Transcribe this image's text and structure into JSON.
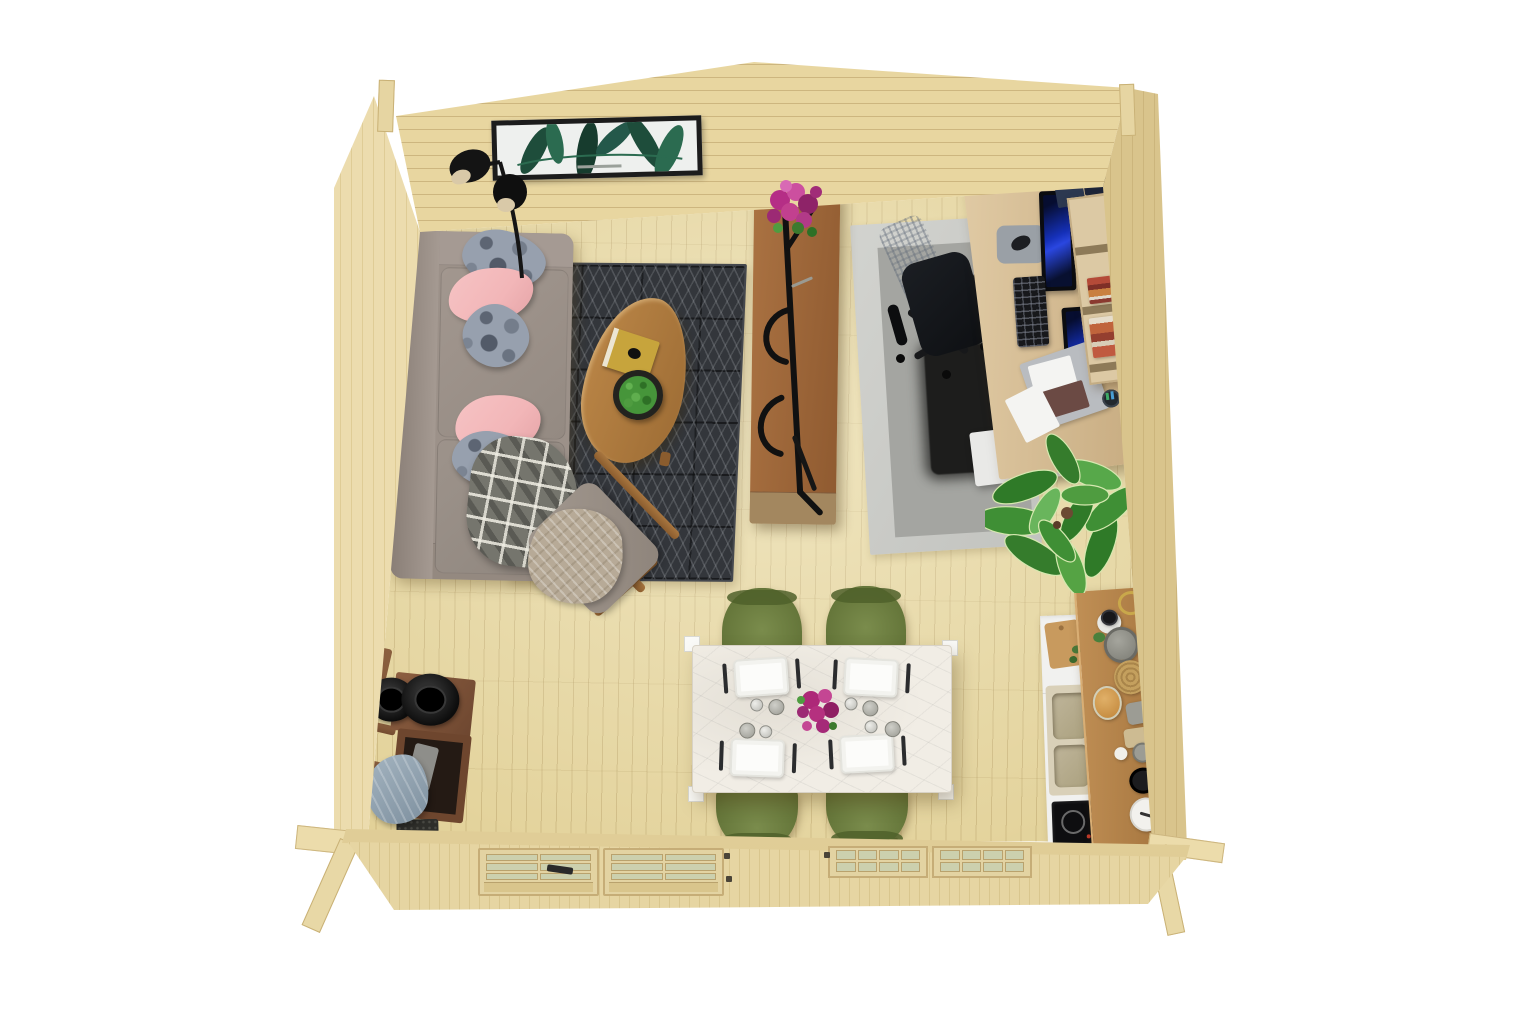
{
  "meta": {
    "title": "Log cabin garden-room interior, 3D top-down render",
    "view": "top-down isometric render on white background",
    "canvas": {
      "width": 1536,
      "height": 1025
    },
    "background": "#ffffff"
  },
  "palette": {
    "floor": "#e2d198",
    "floor_line": "#b89b63",
    "wall": "#e8d6a0",
    "wall_line": "#cdb67f",
    "wall_left": "#ecdcae",
    "wall_right": "#d9c48c",
    "wall_front": "#e6d5a2",
    "rug_dark": "#33363b",
    "rug_line": "#c8cdd2",
    "office_rug_outer": "#cccdc9",
    "office_rug_mid": "#a4a5a1",
    "office_rug_dark": "#1d1d1c",
    "sofa": "#9c9189",
    "sofa_shadow": "#877c74",
    "pillow_pink": "#f2b6b8",
    "pillow_grey": "#97a0ae",
    "blanket_plaid": "#75756d",
    "blanket_knit": "#b7aa97",
    "wood_table": "#b07c3f",
    "wood_divider": "#a06a3e",
    "wood_kitchen": "#b5854e",
    "wood_dark": "#7c5136",
    "desk_wood": "#d8c09a",
    "marble": "#f1ede5",
    "chair_olive": "#6e7f41",
    "ink": "#141414",
    "screen_blue": "#1b2fb0",
    "plant_green": "#3f8f35",
    "flower_magenta": "#b52e86",
    "glass_pane": "#ccd0ae",
    "white_counter": "#f1f1ef",
    "steel": "#9aa0a6",
    "book_yellow": "#c7a43c",
    "books_red": "#b44a38",
    "cloth_blue": "#8ea0ad"
  },
  "scene": {
    "structure": {
      "label": "Pine log cabin shell seen from above",
      "walls": [
        {
          "name": "gable-back-wall",
          "material": "pine planks",
          "shape": "gable with ridge apex"
        },
        {
          "name": "left-wall",
          "material": "pine planks"
        },
        {
          "name": "right-wall",
          "material": "pine planks"
        },
        {
          "name": "front-wall",
          "material": "pine planks",
          "openings": [
            "double glazed door",
            "double casement window"
          ]
        }
      ],
      "door": {
        "label": "Double glazed door",
        "leaves": 2,
        "panes_per_leaf": 6,
        "handle_color": "black"
      },
      "window": {
        "label": "Double casement window",
        "leaves": 2,
        "panes_per_leaf": 8
      }
    },
    "living_area": {
      "label": "Living area",
      "items": [
        {
          "name": "wall-art",
          "label": "Framed tropical palm print with black frame"
        },
        {
          "name": "floor-lamp",
          "label": "Black double-shade floor lamp"
        },
        {
          "name": "sofa",
          "label": "Taupe-grey fabric sofa",
          "pillow_colors": [
            "grey-pattern",
            "pink",
            "grey-pattern",
            "pink",
            "grey-pattern"
          ],
          "throw": "grey check plaid blanket"
        },
        {
          "name": "area-rug",
          "label": "Charcoal rug with geometric triangle line pattern"
        },
        {
          "name": "coffee-table",
          "label": "Leaf-shaped wooden coffee table",
          "on_top": [
            "yellow hardcover book",
            "round boxwood plant bowl"
          ]
        },
        {
          "name": "armchair",
          "label": "Wood-frame lounge chair with grey cushion and beige knit throw"
        }
      ]
    },
    "divider": {
      "label": "Leaning ladder shelf room divider",
      "items": [
        {
          "name": "shelf",
          "label": "Walnut leaning shelf with black metal frame"
        },
        {
          "name": "flowers",
          "label": "Magenta potted flowers on shelf top"
        }
      ]
    },
    "office_area": {
      "label": "Home office corner",
      "items": [
        {
          "name": "layered-rug",
          "label": "Layered rug: light grey, mid grey, black shag center"
        },
        {
          "name": "office-chair",
          "label": "Black mesh swivel office chair"
        },
        {
          "name": "desk",
          "label": "Light oak desk",
          "on_top": [
            "monitor x2 (blue screens)",
            "black keyboard",
            "grey mousepad with mouse",
            "document clipboard",
            "brown notebook",
            "pen cup"
          ]
        },
        {
          "name": "drawer-unit",
          "label": "White under-desk drawer pedestal"
        },
        {
          "name": "cube-bookshelf",
          "label": "Oak cube bookshelf with red and orange book stacks"
        },
        {
          "name": "storage-boxes",
          "label": "Dark blue storage boxes by the wall"
        },
        {
          "name": "plant",
          "label": "Large fiddle-leaf fig plant"
        }
      ],
      "monitor_count": 2
    },
    "dining_area": {
      "label": "Dining area",
      "items": [
        {
          "name": "dining-table",
          "label": "White marble rectangular dining table"
        },
        {
          "name": "chairs",
          "label": "Olive green dining chairs",
          "count": 4
        },
        {
          "name": "place-settings",
          "label": "White plate with fork, knife, glass and cup",
          "count": 4
        },
        {
          "name": "bouquet",
          "label": "Magenta flower centerpiece"
        }
      ]
    },
    "kitchen_area": {
      "label": "Kitchenette along right wall",
      "items": [
        {
          "name": "sink-cabinet",
          "label": "White cabinet with double beige sink and faucet"
        },
        {
          "name": "induction-hob",
          "label": "Black induction hob"
        },
        {
          "name": "cutting-board",
          "label": "Wooden cutting board with herbs"
        },
        {
          "name": "counter-shelf",
          "label": "Wooden counter shelf"
        },
        {
          "name": "counter-items",
          "label": "Jars, pots, woven basket, kettle, tins, canister",
          "count": 11
        }
      ]
    },
    "entry_area": {
      "label": "Entry corner",
      "items": [
        {
          "name": "coat-rack",
          "label": "Dark wood coat rack with ladder side"
        },
        {
          "name": "hats",
          "label": "Black round hats",
          "count": 2
        },
        {
          "name": "scarf",
          "label": "Blue-grey draped scarf"
        },
        {
          "name": "doormat",
          "label": "Small dark doormat"
        }
      ]
    }
  }
}
